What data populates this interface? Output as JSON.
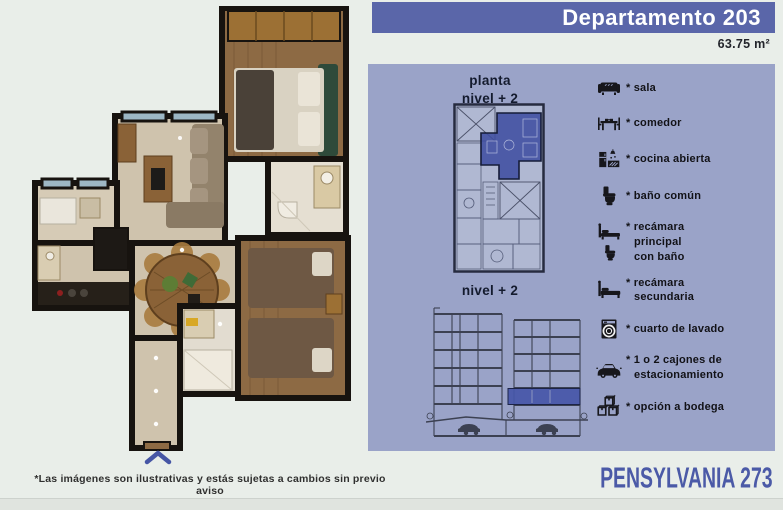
{
  "page": {
    "title": "Departamento 203",
    "area": "63.75 m²"
  },
  "diagrams": {
    "plan_title": "planta\nnivel + 2",
    "section_title": "nivel + 2",
    "highlight_color": "#4150a4"
  },
  "legend": {
    "items": [
      {
        "icon": "sofa-icon",
        "label": "* sala"
      },
      {
        "icon": "dining-table-icon",
        "label": "* comedor"
      },
      {
        "icon": "kitchen-icon",
        "label": "* cocina abierta"
      },
      {
        "icon": "toilet-icon",
        "label": "* baño común"
      },
      {
        "icon": "bed-with-bath-icon",
        "label": "* recámara\nprincipal\ncon baño"
      },
      {
        "icon": "bed-icon",
        "label": "* recámara\nsecundaria"
      },
      {
        "icon": "washing-machine-icon",
        "label": "* cuarto de lavado"
      },
      {
        "icon": "car-icon",
        "label": "* 1 o 2 cajones de\nestacionamiento"
      },
      {
        "icon": "storage-boxes-icon",
        "label": "* opción a bodega"
      }
    ]
  },
  "footer": {
    "disclaimer": "*Las imágenes son ilustrativas y estás sujetas a cambios sin previo aviso",
    "brand": "PENSYLVANIA 273"
  },
  "colors": {
    "background": "#e9eee9",
    "accent_bar": "#5a66a9",
    "panel": "#9aa3c8",
    "brand_text": "#4b5aa7"
  }
}
